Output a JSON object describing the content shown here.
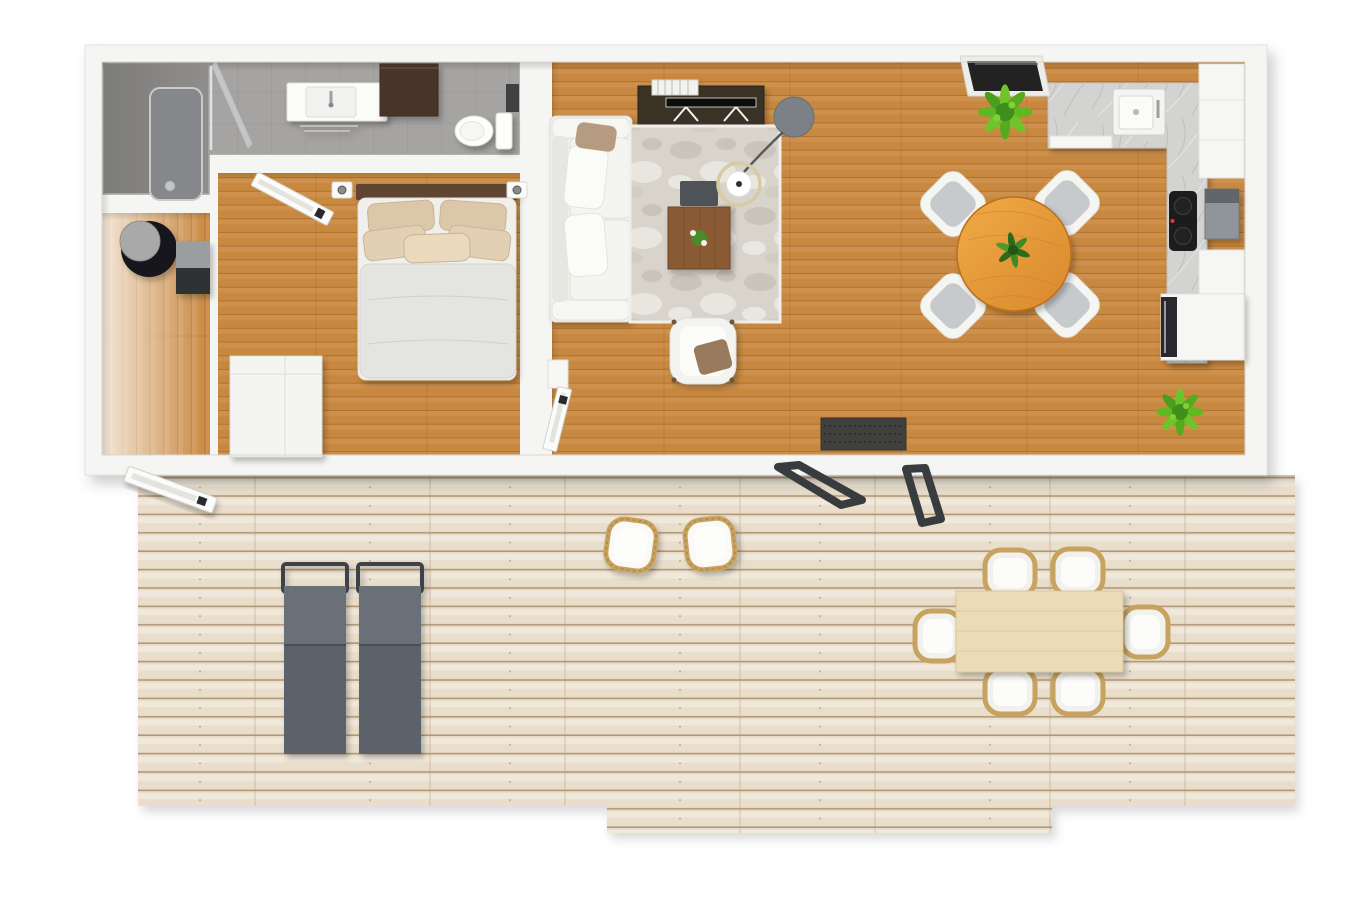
{
  "meta": {
    "view": "top-down-3d-floor-plan",
    "canvas_width": 1350,
    "canvas_height": 900
  },
  "colors": {
    "background": "#ffffff",
    "wall": "#f5f5f3",
    "wall_edge": "#d8d7d3",
    "floor_wood": "#c9883f",
    "floor_wood_line": "#9a5f1e",
    "deck_wood": "#e9decb",
    "deck_wood_line": "#a98c6a",
    "bathroom_tile": "#a6a4a2",
    "shower_floor": "#8f8e8c",
    "rug_base": "#d8d3cb",
    "counter_marble": "#d3d3d2",
    "sofa_white": "#efefeb",
    "armchair_white": "#f3f3f0",
    "bed_mattress": "#f0efec",
    "bed_duvet": "#e4e4e0",
    "pillow_beige": "#dcc7a9",
    "headboard_wood": "#5e4433",
    "tv_console_dark": "#3b3028",
    "bath_cabinet_dark": "#46362a",
    "coffee_table_wood": "#8a5a34",
    "dining_table_orange": "#e8a13f",
    "outdoor_table_wood": "#ebdbb6",
    "lounger_gray": "#5b626a",
    "lounger_frame": "#3e434a",
    "wicker_tan": "#c7a35f",
    "chair_pad_gray": "#c6cacc",
    "plant_green": "#5eb824",
    "plant_green_dark": "#2f6a1d",
    "doormat_dark": "#403f3d",
    "door_panel": "#fbfbf9",
    "patio_door_frame": "#393c3f",
    "window_glass_dark": "#242321",
    "boiler_black": "#17171a",
    "appliance_steel": "#8f959a",
    "cooktop_black": "#1b1b1d",
    "wardrobe_white": "#f4f4f1",
    "toilet_white": "#fdfdfc",
    "lamp_base_gray": "#7b8187",
    "lamp_ring_gold": "#d9caa6"
  },
  "scene": {
    "rooms": [
      {
        "name": "bathroom",
        "floor": "gray-tile",
        "fixtures": [
          "shower",
          "shower-glass",
          "vanity-sink",
          "wall-cabinet-dark",
          "toilet"
        ]
      },
      {
        "name": "hallway",
        "floor": "wood",
        "fixtures": [
          "boiler-cylinder",
          "side-console"
        ]
      },
      {
        "name": "bedroom",
        "floor": "wood",
        "fixtures": [
          "double-bed",
          "headboard",
          "pillows",
          "wall-sconce-left",
          "wall-sconce-right",
          "wardrobe",
          "door-open"
        ]
      },
      {
        "name": "living-room",
        "floor": "wood",
        "fixtures": [
          "tv-console",
          "books",
          "flat-tv",
          "sofa-white",
          "marble-rug",
          "coffee-table",
          "plant-on-table",
          "dark-tray",
          "arc-lamp",
          "armchair",
          "door-open",
          "doormat"
        ]
      },
      {
        "name": "kitchen",
        "floor": "wood",
        "fixtures": [
          "l-counter-marble",
          "sink",
          "cooktop",
          "steel-appliance",
          "tall-cabinet",
          "mid-cabinet",
          "oven-block",
          "tilt-window"
        ]
      },
      {
        "name": "dining-area",
        "floor": "wood",
        "fixtures": [
          "round-table-orange",
          "chair-x4",
          "table-plant",
          "floor-plant-x2"
        ]
      },
      {
        "name": "deck-terrace",
        "floor": "whitewashed-planks",
        "fixtures": [
          "sun-lounger-x2",
          "bistro-chair-x2",
          "outdoor-table",
          "outdoor-chair-x6",
          "entry-door-open",
          "patio-door-panel-x2"
        ]
      }
    ]
  }
}
